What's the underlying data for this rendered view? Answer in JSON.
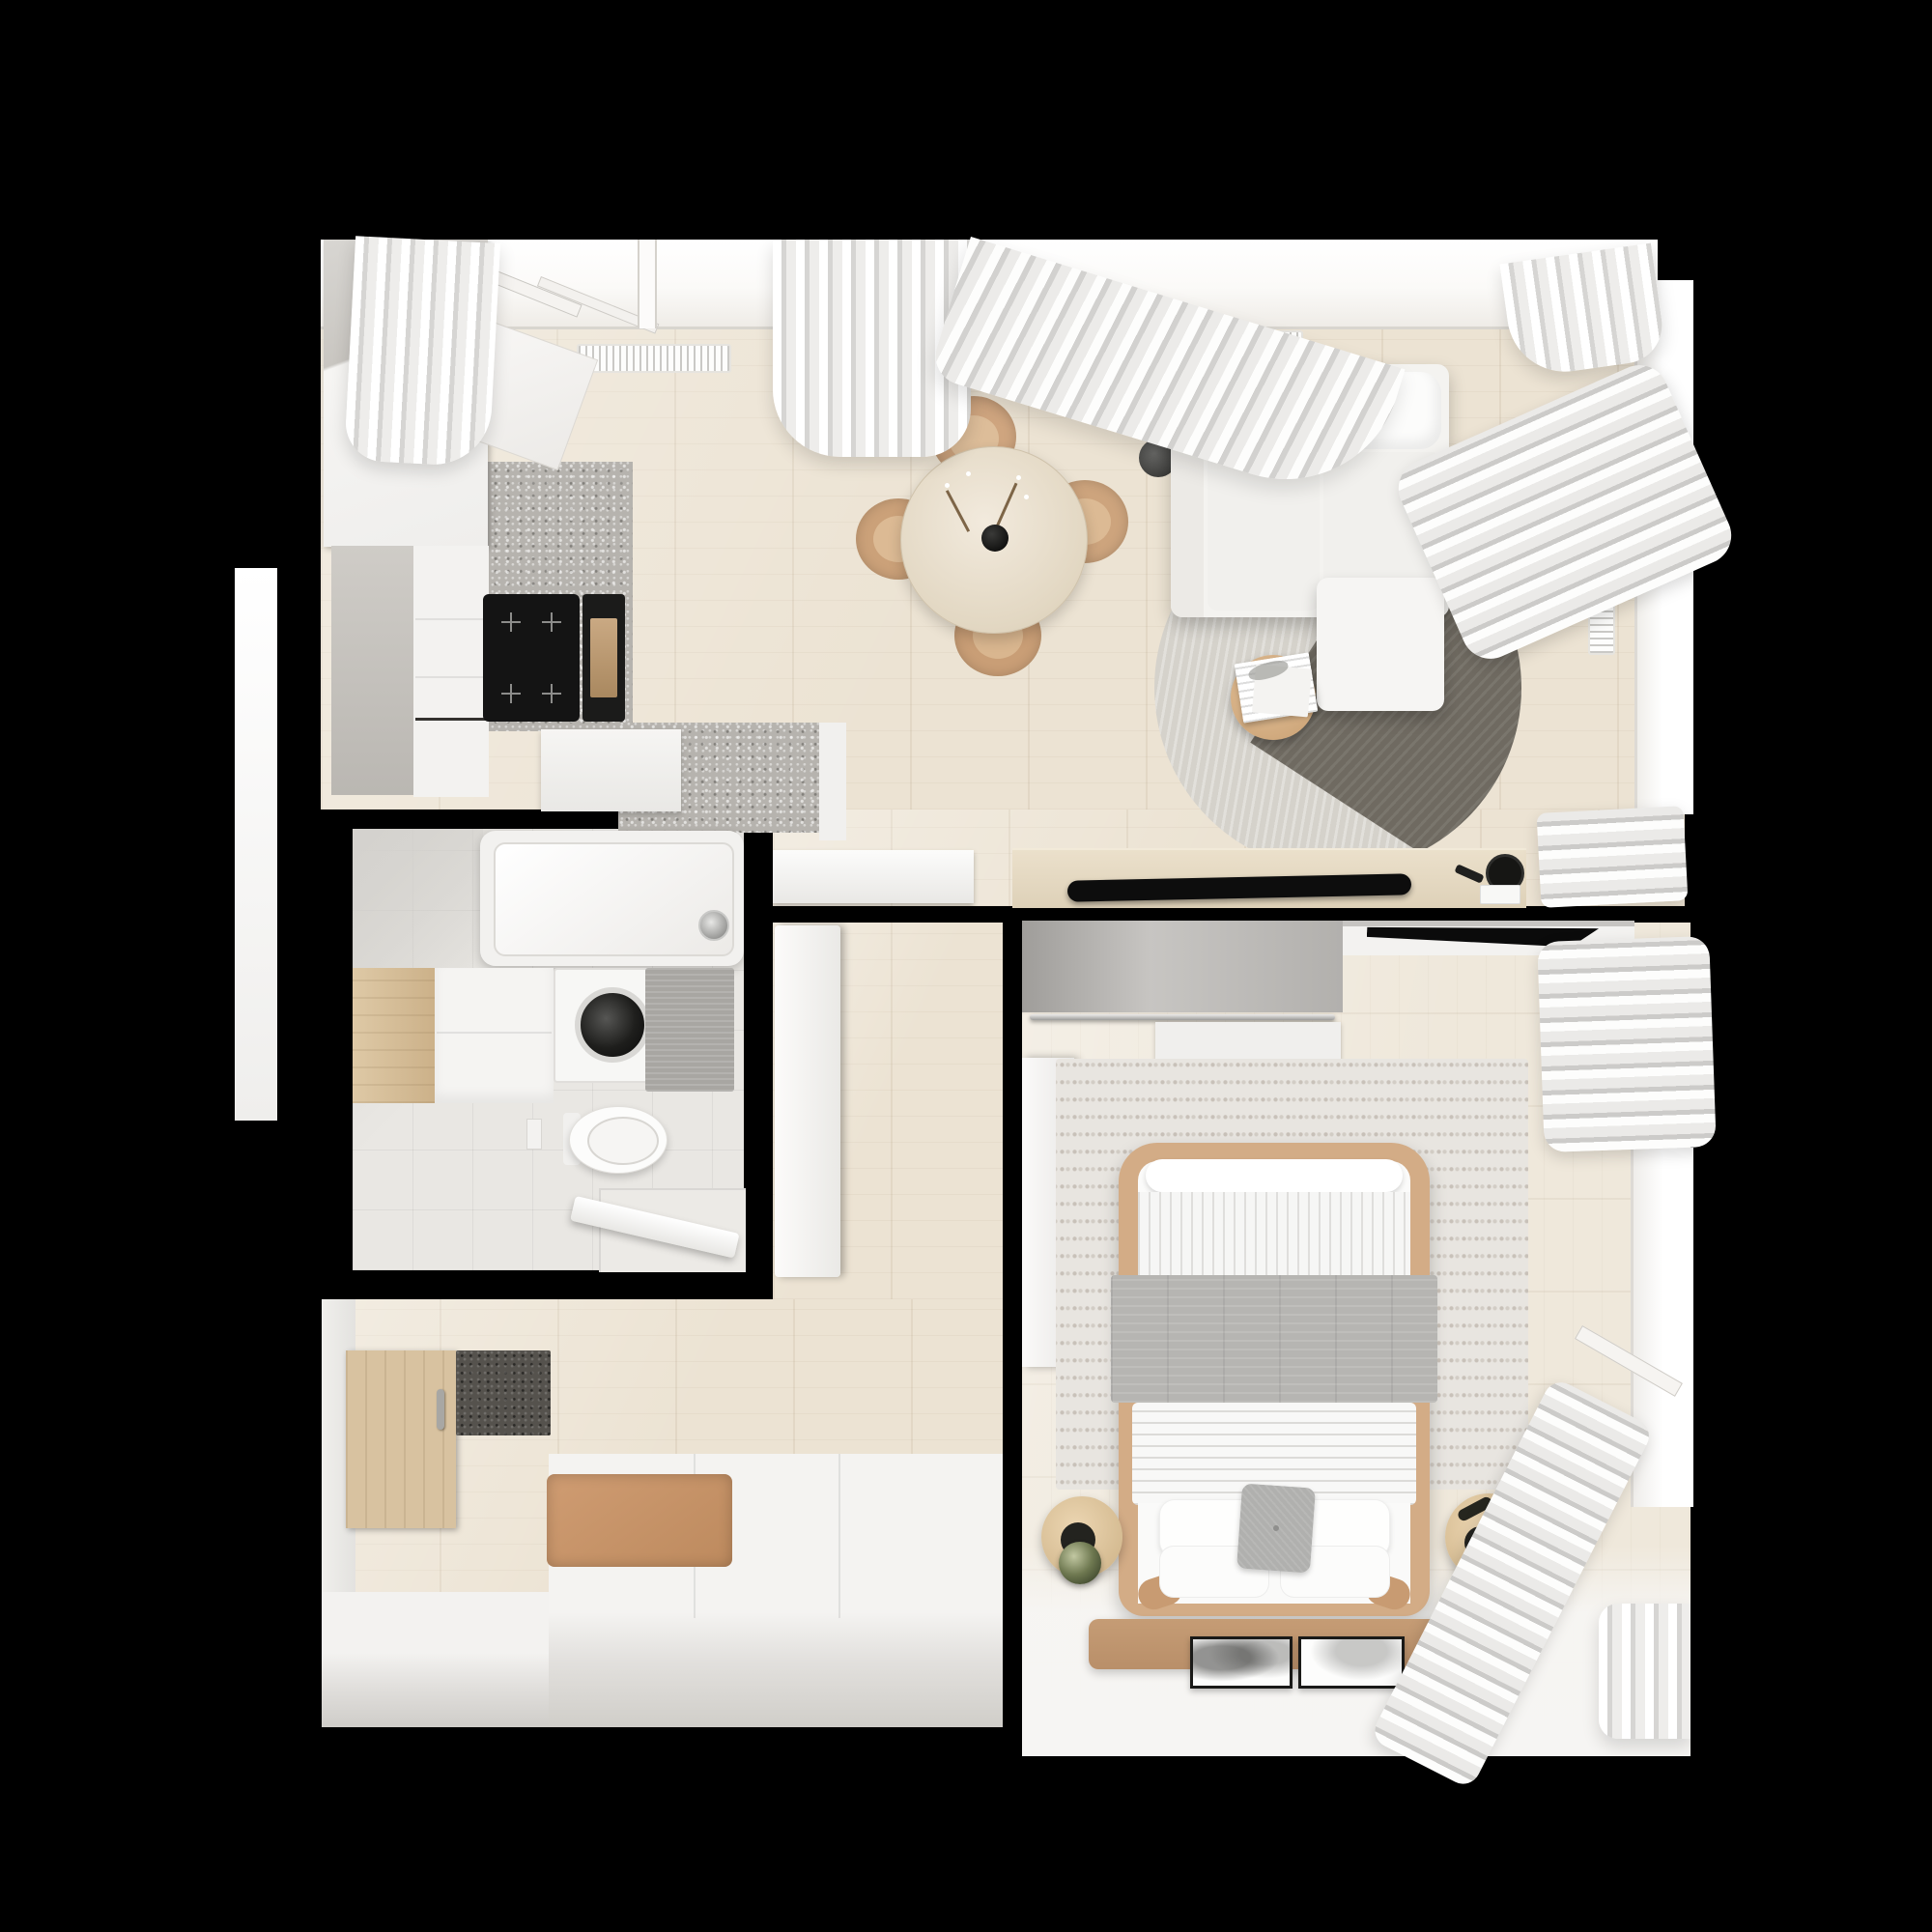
{
  "scene": {
    "title": "Top-down 3D render of a small apartment floor plan",
    "view": "top-down",
    "background_color": "#000000"
  },
  "palette": {
    "walls": "#000000",
    "wood_floor": "#ece3d3",
    "pale_wood_floor": "#efe8db",
    "tile_floor": "#e9e7e3",
    "white_furniture": "#f4f3f1",
    "terrazzo_counter": "#b6b3ae",
    "tan_leather": "#c8956c",
    "light_wood": "#d8c2a0",
    "gray_blanket": "#b6b5b2",
    "rug_light": "#d5d2cb",
    "rug_dark": "#6f6a61",
    "curtain": "#e8e7e5",
    "knit_rug": "#e8e5e0",
    "green_glass": "#6e7850",
    "appliance_black": "#141414"
  },
  "rooms": [
    {
      "id": "living-kitchen-dining",
      "label": "Open living, kitchen and dining room",
      "furniture": [
        "kitchen tall cabinets",
        "terrazzo counter",
        "induction cooktop",
        "built-in oven",
        "kitchen island",
        "white sideboard",
        "round dining table",
        "black vase with blossom branches",
        "four dining chairs",
        "floor lamp",
        "L-shaped white sofa",
        "round two-tone rug",
        "round coffee table",
        "open magazine",
        "wooden media console",
        "flat TV",
        "round speaker",
        "remote",
        "top windows with radiators",
        "right window with vertical radiator",
        "sheer curtains"
      ]
    },
    {
      "id": "bathroom",
      "label": "Bathroom",
      "furniture": [
        "bathtub with chrome faucet",
        "washing machine",
        "vanity with wooden side unit",
        "wall-hung toilet",
        "flush plate",
        "gray bath mat",
        "shower corner with open door"
      ]
    },
    {
      "id": "corridor",
      "label": "Corridor",
      "furniture": [
        "open white bathroom door"
      ]
    },
    {
      "id": "entry",
      "label": "Entry hall",
      "furniture": [
        "wooden coat panel with handle",
        "dark doormat",
        "white storage bench",
        "tan seat cushion"
      ]
    },
    {
      "id": "bedroom",
      "label": "Bedroom",
      "furniture": [
        "open wardrobe with clothes rail",
        "white shelf",
        "white door panel",
        "wall-mounted TV",
        "knitted area rug",
        "double bed with tan frame",
        "gray blanket",
        "white duvet",
        "four white pillows",
        "gray cushion",
        "two round wooden nightstands",
        "two green glass lamps",
        "sunglasses",
        "tan runner rug",
        "two framed prints on floor",
        "window and stacked curtains"
      ]
    }
  ],
  "counts": {
    "rooms": 5,
    "dining_chairs": 4,
    "bed_pillows": 4,
    "framed_prints": 2,
    "nightstands": 2,
    "radiators": 3
  }
}
